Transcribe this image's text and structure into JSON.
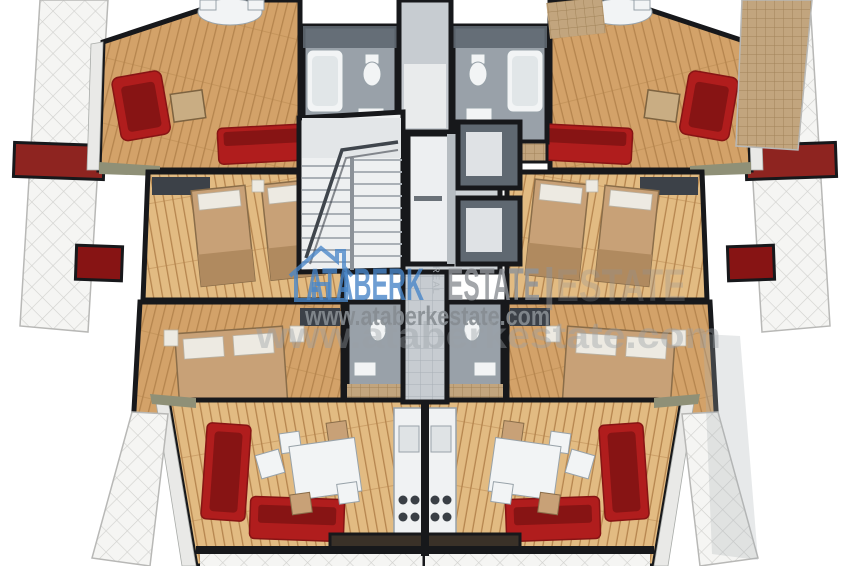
{
  "canvas": {
    "width": 850,
    "height": 566
  },
  "watermark": {
    "logo_icon": "house-outline-icon",
    "brand_word_primary": "ATABERK",
    "brand_word_vertical": "REAL",
    "brand_word_secondary": "ESTATE",
    "brand_word_secondary_echo": "ESTATE",
    "separator": "|",
    "website": "www.ataberkestate.com",
    "website_echo": "www.ataberkestate.com"
  },
  "palette": {
    "background": "#ffffff",
    "wall": "#17181b",
    "wood_floor": "#d3a269",
    "wood_dark": "#b5854e",
    "wood_light": "#e2bb82",
    "gray_floor": "#99a1a9",
    "gray_wall": "#5f6871",
    "light_gray": "#c7ccd1",
    "white_fixture": "#f2f4f5",
    "sofa_red": "#b01d1d",
    "sofa_red_dark": "#871414",
    "bed_tan": "#c8a177",
    "bed_tan_dark": "#b08a5f",
    "pillow": "#edeae2",
    "tile_white": "#f5f5f3",
    "tile_line": "#d2d2cf",
    "tan_tile": "#c2a57e",
    "tan_tile_line": "#a18459",
    "stair_tread": "#aab0b6",
    "counter_dark": "#3a3128",
    "accent_red_panel": "#8e2420",
    "olive_wall": "#8f9077",
    "watermark_blue": "#4a87c9",
    "watermark_gray": "#8f9398",
    "watermark_site": "#878d92"
  },
  "scene": {
    "type": "3d-isometric-floor-plan",
    "units": [
      "apartment-left",
      "apartment-right"
    ],
    "core": [
      "staircase",
      "elevator",
      "corridor",
      "service-shafts"
    ],
    "rooms_per_unit": [
      "living-room",
      "bathroom",
      "bedroom-twin",
      "bedroom-double",
      "wc",
      "living-dining-room",
      "kitchen",
      "balcony"
    ]
  }
}
